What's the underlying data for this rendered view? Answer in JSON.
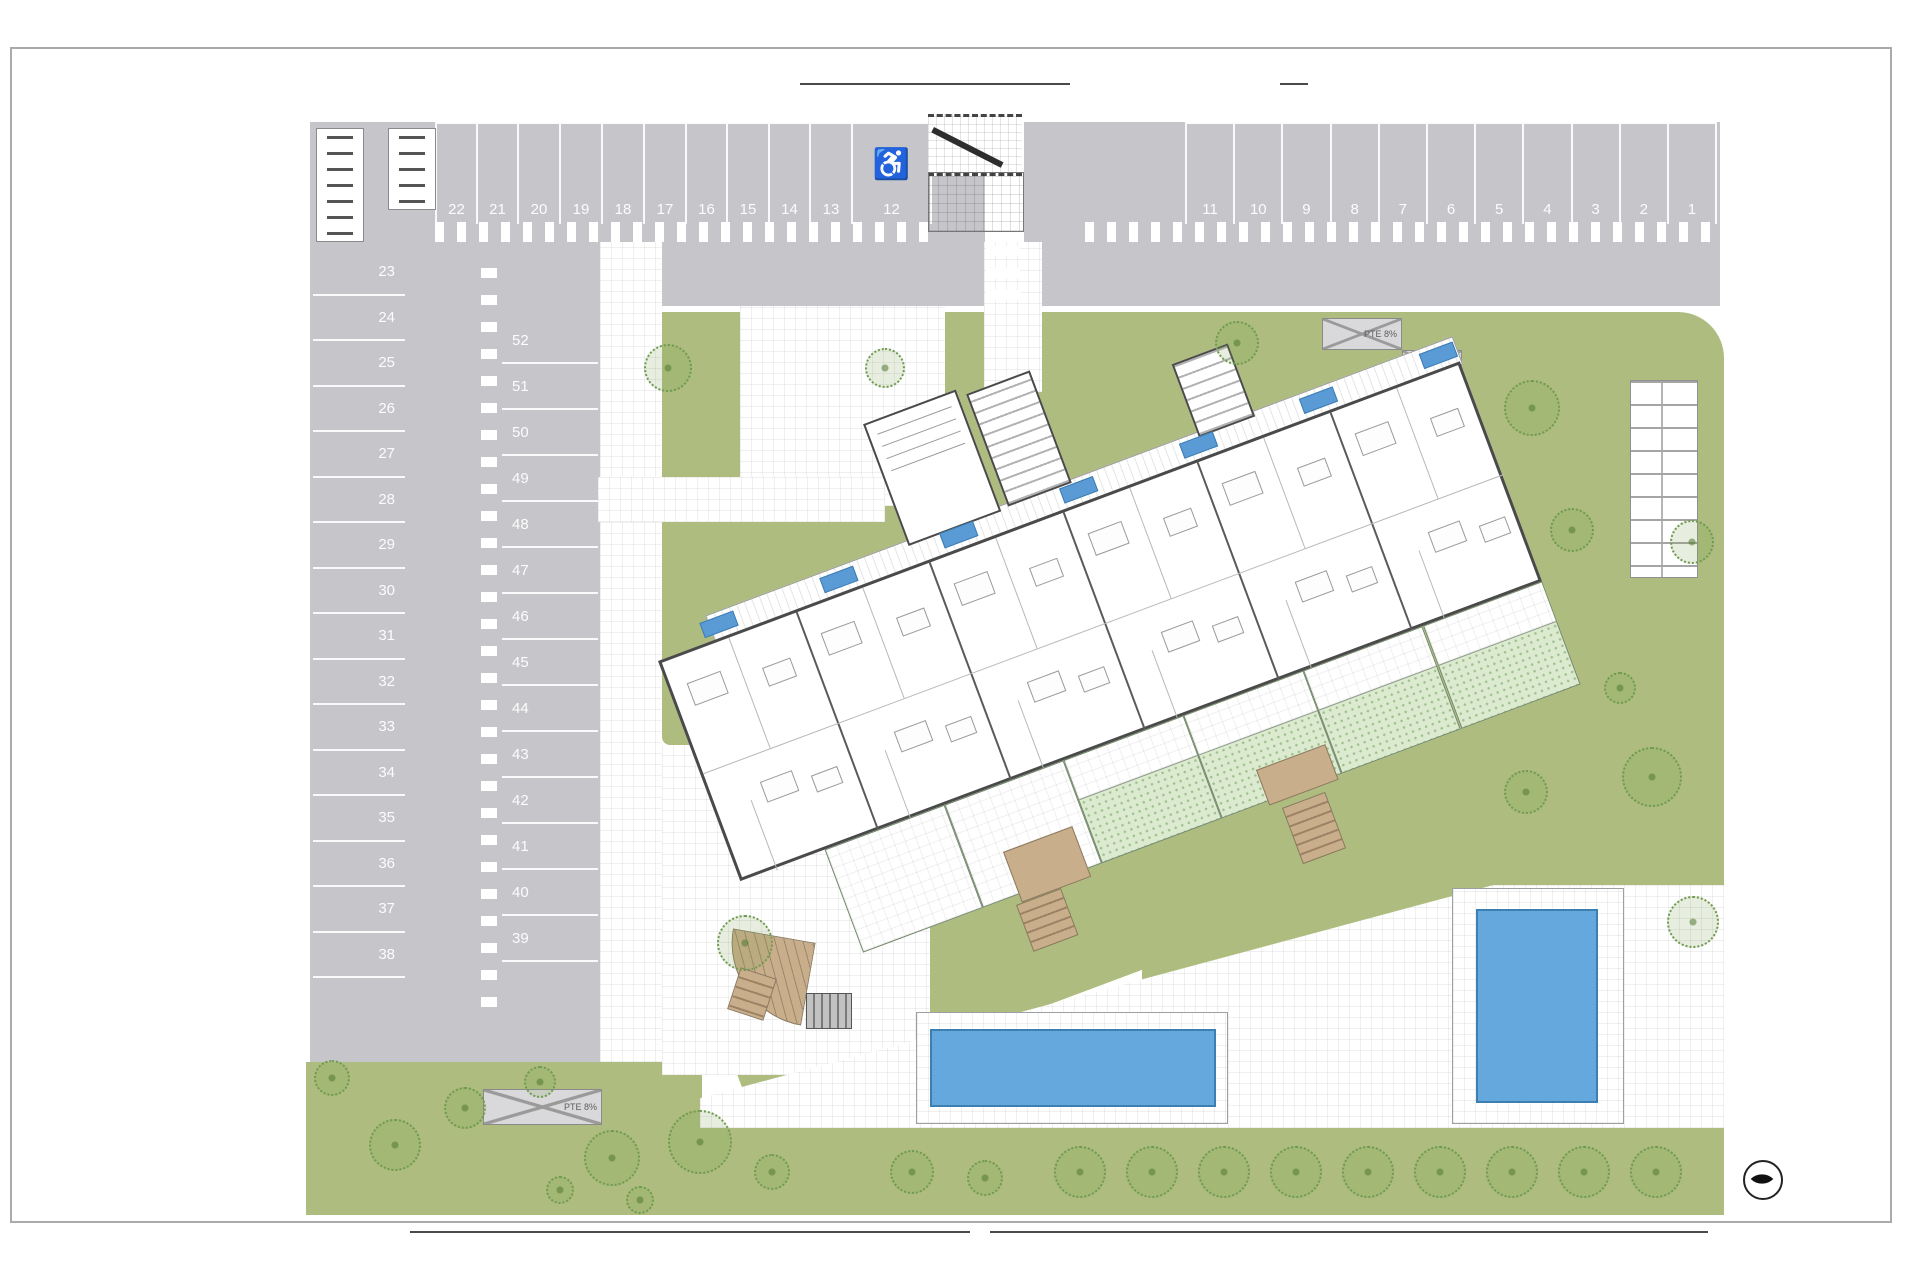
{
  "parking": {
    "row_top_left": [
      "22",
      "21",
      "20",
      "19",
      "18",
      "17",
      "16",
      "15",
      "14",
      "13",
      "12"
    ],
    "row_top_right": [
      "11",
      "10",
      "9",
      "8",
      "7",
      "6",
      "5",
      "4",
      "3",
      "2",
      "1"
    ],
    "column_left": [
      "23",
      "24",
      "25",
      "26",
      "27",
      "28",
      "29",
      "30",
      "31",
      "32",
      "33",
      "34",
      "35",
      "36",
      "37",
      "38"
    ],
    "column_middle": [
      "52",
      "51",
      "50",
      "49",
      "48",
      "47",
      "46",
      "45",
      "44",
      "43",
      "42",
      "41",
      "40",
      "39"
    ],
    "accessible_space_number": "12",
    "accessible_symbol": "♿"
  },
  "ramps": {
    "garage_ramp_label": "PTE 8%",
    "upper_ramp_a_label": "PTE 8%",
    "upper_ramp_b_label": "PTE 8%"
  },
  "colors": {
    "asphalt": "#c6c6ca",
    "lawn": "#aebd7f",
    "garden": "#dcead0",
    "pool": "#64a8de",
    "timber": "#c9ae8c",
    "unit_tag": "#5b9bd5",
    "wall": "#4a4a4a",
    "marking": "#ffffff"
  }
}
